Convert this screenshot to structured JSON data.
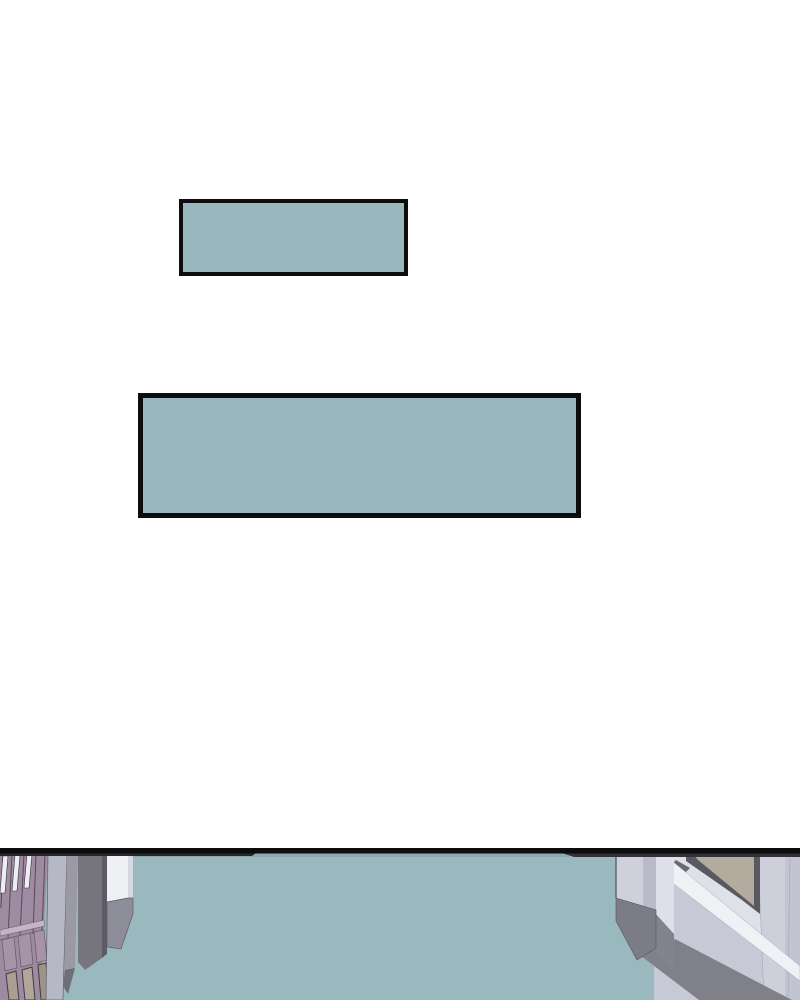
{
  "page": {
    "background": "#ffffff",
    "kind": "webtoon-comic-page"
  },
  "caption_boxes": [
    {
      "name": "small",
      "text": "",
      "fill": "#98b8bd",
      "border": "#0d0d0d"
    },
    {
      "name": "large",
      "text": "",
      "fill": "#98b8bd",
      "border": "#0d0d0d"
    }
  ],
  "panel": {
    "description": "high-angle street scene between two buildings, cropped at page bottom",
    "border_color": "#0d0d0d",
    "shadow_strip_left": "#26262b",
    "shadow_strip_right": "#303036",
    "colors": {
      "street": "#9ab9be",
      "street_top_edge": "#8ea9af",
      "left_facade": "#9e8ba1",
      "facade_line": "#554b5c",
      "window_slit": "#eceef3",
      "slit_outline": "#3c3540",
      "ledge": "#c2b6c4",
      "ledge_line": "#6b5f70",
      "facade_panel": "#a793a8",
      "door_panel_a": "#a89f90",
      "door_panel_b": "#b0a798",
      "door_panel_c": "#9d9487",
      "door_outline": "#3f3a45",
      "column_light": "#b6b9c5",
      "column_mid": "#9a99a5",
      "column_mid_dark": "#6e6e76",
      "column_dark": "#77767f",
      "column_edge": "#5d5c66",
      "column_white": "#eef0f4",
      "column_white_side": "#d6d8e2",
      "column_base": "#8d8d99",
      "right_wall": "#c7cad6",
      "right_wall_upper": "#dfe1e9",
      "right_seam_strip": "#cdd0db",
      "right_far_strip": "#c2c5d1",
      "molding": "#f0f1f5",
      "molding_edge": "#a8a8b2",
      "wall_base_shadow": "#80808a",
      "recess_strip": "#dde0e8",
      "recess_base": "#83838d",
      "pillar_side": "#b9bcc8",
      "pillar_face": "#ced1db",
      "pillar_base": "#7c7c86",
      "pillar_outline": "#55555e",
      "window_frame": "#595962",
      "window_glass": "#b3ab9d",
      "window_sill": "#6a6a72"
    }
  }
}
